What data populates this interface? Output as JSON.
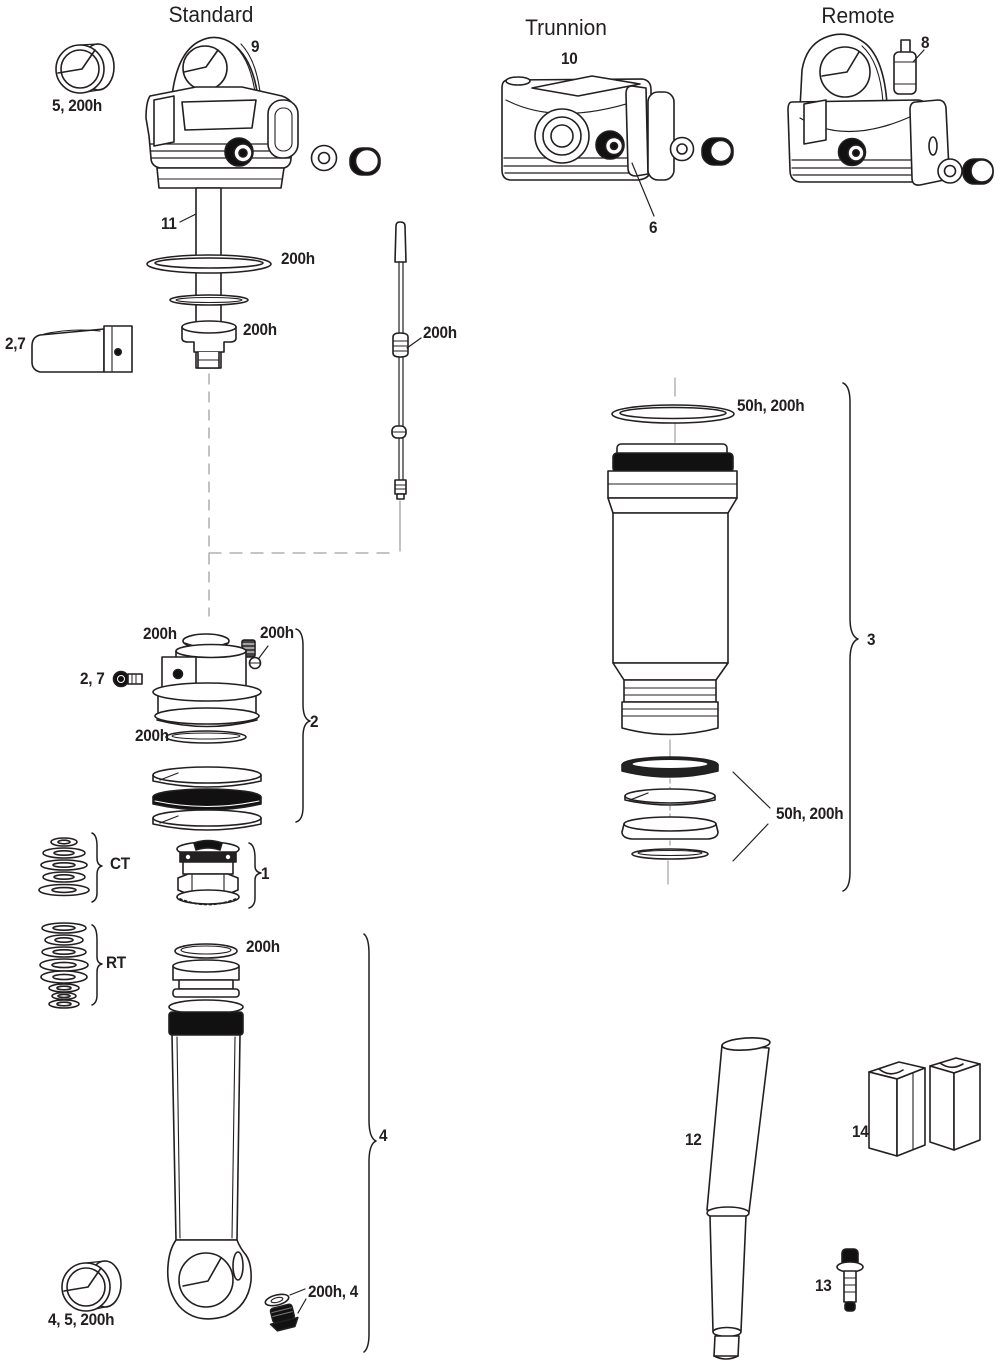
{
  "page": {
    "background": "#ffffff",
    "ink_color": "#231f20",
    "dark_fill": "#111111",
    "connector_color": "#a0a0a0"
  },
  "sections": {
    "standard": {
      "title": "Standard"
    },
    "trunnion": {
      "title": "Trunnion"
    },
    "remote": {
      "title": "Remote"
    }
  },
  "callouts": {
    "n1": "1",
    "n2": "2",
    "n3": "3",
    "n4": "4",
    "n6": "6",
    "n8": "8",
    "n9": "9",
    "n10": "10",
    "n11": "11",
    "n12": "12",
    "n13": "13",
    "n14": "14",
    "ct": "CT",
    "rt": "RT"
  },
  "service_intervals": {
    "bushing_top": "5, 200h",
    "clamp_top": "2,7",
    "shaft_oring": "200h",
    "bumper": "200h",
    "rebound_rod": "200h",
    "aircan_top_seal": "50h, 200h",
    "aircan_bottom_seals": "50h, 200h",
    "piston_cap_seal": "200h",
    "piston_set_screw": "200h",
    "piston_bolt": "2, 7",
    "piston_oring": "200h",
    "sealhead_oring": "200h",
    "valve_parts": "200h, 4",
    "bushing_bottom": "4, 5, 200h"
  }
}
